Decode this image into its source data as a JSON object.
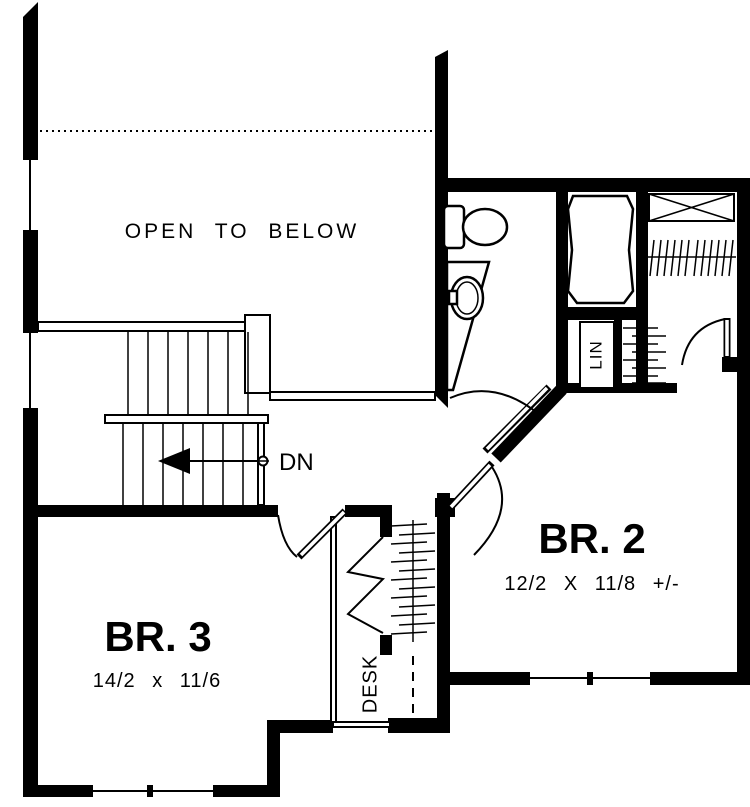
{
  "colors": {
    "line": "#000000",
    "background": "#ffffff"
  },
  "labels": {
    "open_to_below": "OPEN TO BELOW",
    "stairs_direction": "DN",
    "bedroom2": {
      "name": "BR. 2",
      "dimensions": "12/2 X 11/8 +/-"
    },
    "bedroom3": {
      "name": "BR. 3",
      "dimensions": "14/2 x 11/6"
    },
    "linen_closet": "LIN",
    "desk": "DESK"
  }
}
